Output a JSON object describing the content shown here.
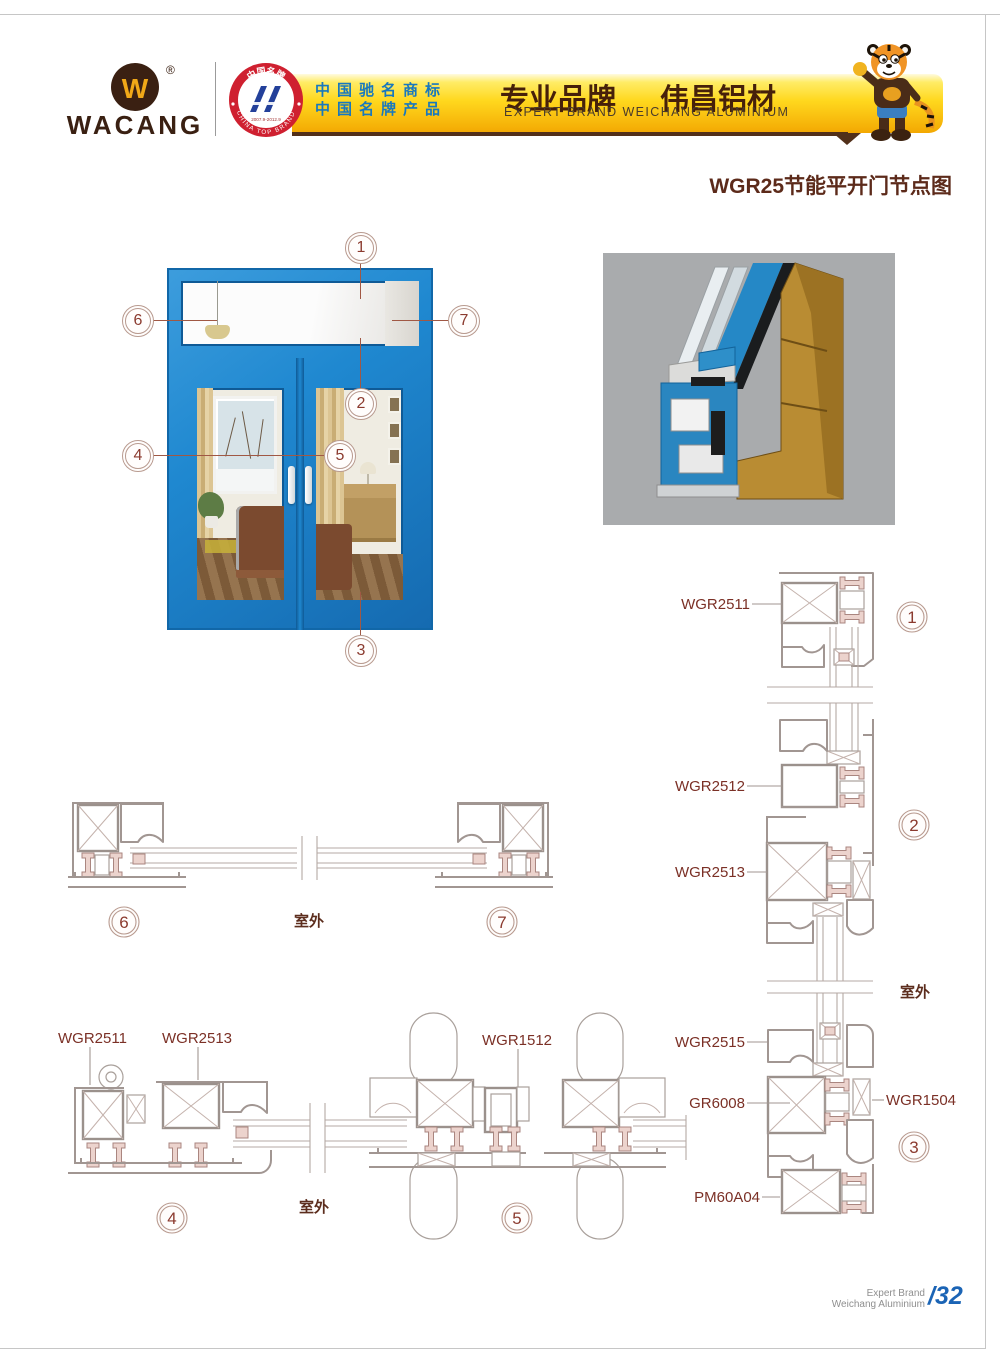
{
  "page": {
    "title": "WGR25节能平开门节点图"
  },
  "header": {
    "brand": "WACANG",
    "reg": "®",
    "logo_w": "W",
    "badge": {
      "arc_top": "中国名牌",
      "arc_bottom": "CHINA TOP BRAND",
      "years": "2007.9-2012.9"
    },
    "banner": {
      "line1": "中国驰名商标",
      "line2": "中国名牌产品",
      "slogan_cn": "专业品牌",
      "brand_cn": "伟昌铝材",
      "slogan_en": "EXPERT BRAND WEICHANG ALUMINIUM"
    }
  },
  "callouts": {
    "c1": "1",
    "c2": "2",
    "c3": "3",
    "c4": "4",
    "c5": "5",
    "c6": "6",
    "c7": "7"
  },
  "labels": {
    "outdoor": "室外",
    "wgr2511": "WGR2511",
    "wgr2512": "WGR2512",
    "wgr2513": "WGR2513",
    "wgr2515": "WGR2515",
    "gr6008": "GR6008",
    "wgr1504": "WGR1504",
    "pm60a04": "PM60A04",
    "wgr1512": "WGR1512"
  },
  "footer": {
    "line1": "Expert Brand",
    "line2": "Weichang Aluminium",
    "page_no": "/32"
  },
  "colors": {
    "banner_yellow": "#ffd81e",
    "brand_brown": "#3a2012",
    "title_maroon": "#5c2a1a",
    "label_maroon": "#7b3026",
    "drawing_gray": "#a19692",
    "thermal_pink": "#ecd3cd",
    "frame_blue": "#1f88d0",
    "footer_blue": "#1b64b5",
    "badge_red": "#cf2030",
    "emblem_blue": "#23409a"
  }
}
